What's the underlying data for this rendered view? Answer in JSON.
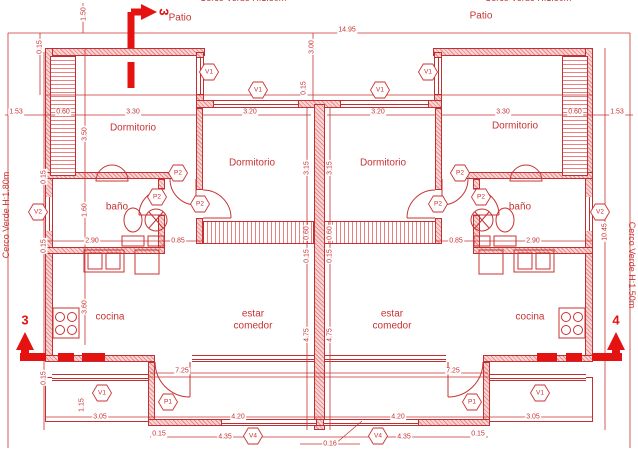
{
  "colors": {
    "line_red": "#c83232",
    "wall_red": "#c03030",
    "section_red": "#e51212"
  },
  "sections": {
    "s3_top": "3",
    "s3_bottom": "3",
    "s4": "4"
  },
  "room_labels": [
    {
      "text": "Dormitorio",
      "x": 133,
      "y": 128,
      "w": 70
    },
    {
      "text": "Dormitorio",
      "x": 252,
      "y": 163,
      "w": 70
    },
    {
      "text": "Dormitorio",
      "x": 383,
      "y": 163,
      "w": 70
    },
    {
      "text": "Dormitorio",
      "x": 515,
      "y": 126,
      "w": 70
    },
    {
      "text": "baño",
      "x": 117,
      "y": 207,
      "w": 40
    },
    {
      "text": "baño",
      "x": 520,
      "y": 207,
      "w": 40
    },
    {
      "text": "cocina",
      "x": 110,
      "y": 317,
      "w": 50
    },
    {
      "text": "cocina",
      "x": 530,
      "y": 317,
      "w": 50
    },
    {
      "text": "estar comedor",
      "x": 253,
      "y": 320,
      "w": 56
    },
    {
      "text": "estar comedor",
      "x": 392,
      "y": 320,
      "w": 56
    },
    {
      "text": "Patio",
      "x": 180,
      "y": 18,
      "w": 40
    },
    {
      "text": "Patio",
      "x": 481,
      "y": 16,
      "w": 40
    }
  ],
  "perimeter_labels": [
    {
      "text": "Cerco Verde H:1.80m",
      "x": 243,
      "y": -2,
      "r": 0
    },
    {
      "text": "Cerco Verde H:1.80m",
      "x": 528,
      "y": -2,
      "r": 0
    },
    {
      "text": "Cerco Verde H:1.80m",
      "x": 6,
      "y": 215,
      "r": -90
    },
    {
      "text": "Cerco Verde H:1.50m",
      "x": 632,
      "y": 265,
      "r": 90
    }
  ],
  "markers": [
    {
      "t": "V1",
      "x": 209,
      "y": 72
    },
    {
      "t": "V1",
      "x": 258,
      "y": 90
    },
    {
      "t": "V1",
      "x": 380,
      "y": 90
    },
    {
      "t": "V1",
      "x": 428,
      "y": 72
    },
    {
      "t": "V2",
      "x": 38,
      "y": 212
    },
    {
      "t": "V2",
      "x": 600,
      "y": 212
    },
    {
      "t": "P2",
      "x": 178,
      "y": 173
    },
    {
      "t": "P2",
      "x": 157,
      "y": 197
    },
    {
      "t": "P2",
      "x": 200,
      "y": 204
    },
    {
      "t": "P2",
      "x": 460,
      "y": 173
    },
    {
      "t": "P2",
      "x": 481,
      "y": 197
    },
    {
      "t": "P2",
      "x": 438,
      "y": 204
    },
    {
      "t": "P1",
      "x": 168,
      "y": 402
    },
    {
      "t": "P1",
      "x": 472,
      "y": 402
    },
    {
      "t": "V1",
      "x": 102,
      "y": 393
    },
    {
      "t": "V1",
      "x": 540,
      "y": 393
    },
    {
      "t": "V4",
      "x": 253,
      "y": 436
    },
    {
      "t": "V4",
      "x": 378,
      "y": 436
    }
  ],
  "dims": [
    {
      "v": "14.95",
      "x": 347,
      "y": 30,
      "r": 0
    },
    {
      "v": "3.00",
      "x": 312,
      "y": 47,
      "r": 1
    },
    {
      "v": "1.50",
      "x": 84,
      "y": 14,
      "r": 1
    },
    {
      "v": "0.15",
      "x": 40,
      "y": 47,
      "r": 1
    },
    {
      "v": "1.53",
      "x": 16,
      "y": 112,
      "r": 0
    },
    {
      "v": "0.60",
      "x": 63,
      "y": 112,
      "r": 0
    },
    {
      "v": "3.30",
      "x": 133,
      "y": 112,
      "r": 0
    },
    {
      "v": "3.20",
      "x": 250,
      "y": 112,
      "r": 0
    },
    {
      "v": "0.15",
      "x": 304,
      "y": 88,
      "r": 1
    },
    {
      "v": "3.20",
      "x": 378,
      "y": 112,
      "r": 0
    },
    {
      "v": "3.30",
      "x": 503,
      "y": 112,
      "r": 0
    },
    {
      "v": "0.60",
      "x": 575,
      "y": 112,
      "r": 0
    },
    {
      "v": "1.53",
      "x": 617,
      "y": 112,
      "r": 0
    },
    {
      "v": "3.50",
      "x": 85,
      "y": 134,
      "r": 1
    },
    {
      "v": "0.15",
      "x": 44,
      "y": 177,
      "r": 1
    },
    {
      "v": "1.60",
      "x": 85,
      "y": 210,
      "r": 1
    },
    {
      "v": "2.90",
      "x": 92,
      "y": 241,
      "r": 0
    },
    {
      "v": "0.85",
      "x": 178,
      "y": 241,
      "r": 0
    },
    {
      "v": "3.15",
      "x": 307,
      "y": 168,
      "r": 1
    },
    {
      "v": "3.15",
      "x": 330,
      "y": 168,
      "r": 1
    },
    {
      "v": "0.60",
      "x": 307,
      "y": 233,
      "r": 1
    },
    {
      "v": "0.60",
      "x": 330,
      "y": 233,
      "r": 1
    },
    {
      "v": "0.15",
      "x": 307,
      "y": 256,
      "r": 1
    },
    {
      "v": "0.15",
      "x": 330,
      "y": 256,
      "r": 1
    },
    {
      "v": "0.85",
      "x": 456,
      "y": 241,
      "r": 0
    },
    {
      "v": "2.90",
      "x": 533,
      "y": 241,
      "r": 0
    },
    {
      "v": "10.45",
      "x": 605,
      "y": 232,
      "r": 1
    },
    {
      "v": "0.15",
      "x": 44,
      "y": 246,
      "r": 1
    },
    {
      "v": "3.60",
      "x": 85,
      "y": 307,
      "r": 1
    },
    {
      "v": "4.75",
      "x": 307,
      "y": 335,
      "r": 1
    },
    {
      "v": "4.75",
      "x": 330,
      "y": 335,
      "r": 1
    },
    {
      "v": "7.25",
      "x": 182,
      "y": 371,
      "r": 0
    },
    {
      "v": "7.25",
      "x": 453,
      "y": 371,
      "r": 0
    },
    {
      "v": "0.15",
      "x": 44,
      "y": 378,
      "r": 1
    },
    {
      "v": "1.15",
      "x": 82,
      "y": 405,
      "r": 1
    },
    {
      "v": "3.05",
      "x": 100,
      "y": 417,
      "r": 0
    },
    {
      "v": "4.20",
      "x": 238,
      "y": 417,
      "r": 0
    },
    {
      "v": "4.20",
      "x": 398,
      "y": 417,
      "r": 0
    },
    {
      "v": "4.35",
      "x": 225,
      "y": 437,
      "r": 0
    },
    {
      "v": "4.35",
      "x": 404,
      "y": 437,
      "r": 0
    },
    {
      "v": "3.05",
      "x": 533,
      "y": 417,
      "r": 0
    },
    {
      "v": "0.15",
      "x": 159,
      "y": 434,
      "r": 0
    },
    {
      "v": "0.16",
      "x": 330,
      "y": 444,
      "r": 0
    },
    {
      "v": "0.15",
      "x": 478,
      "y": 434,
      "r": 0
    }
  ]
}
